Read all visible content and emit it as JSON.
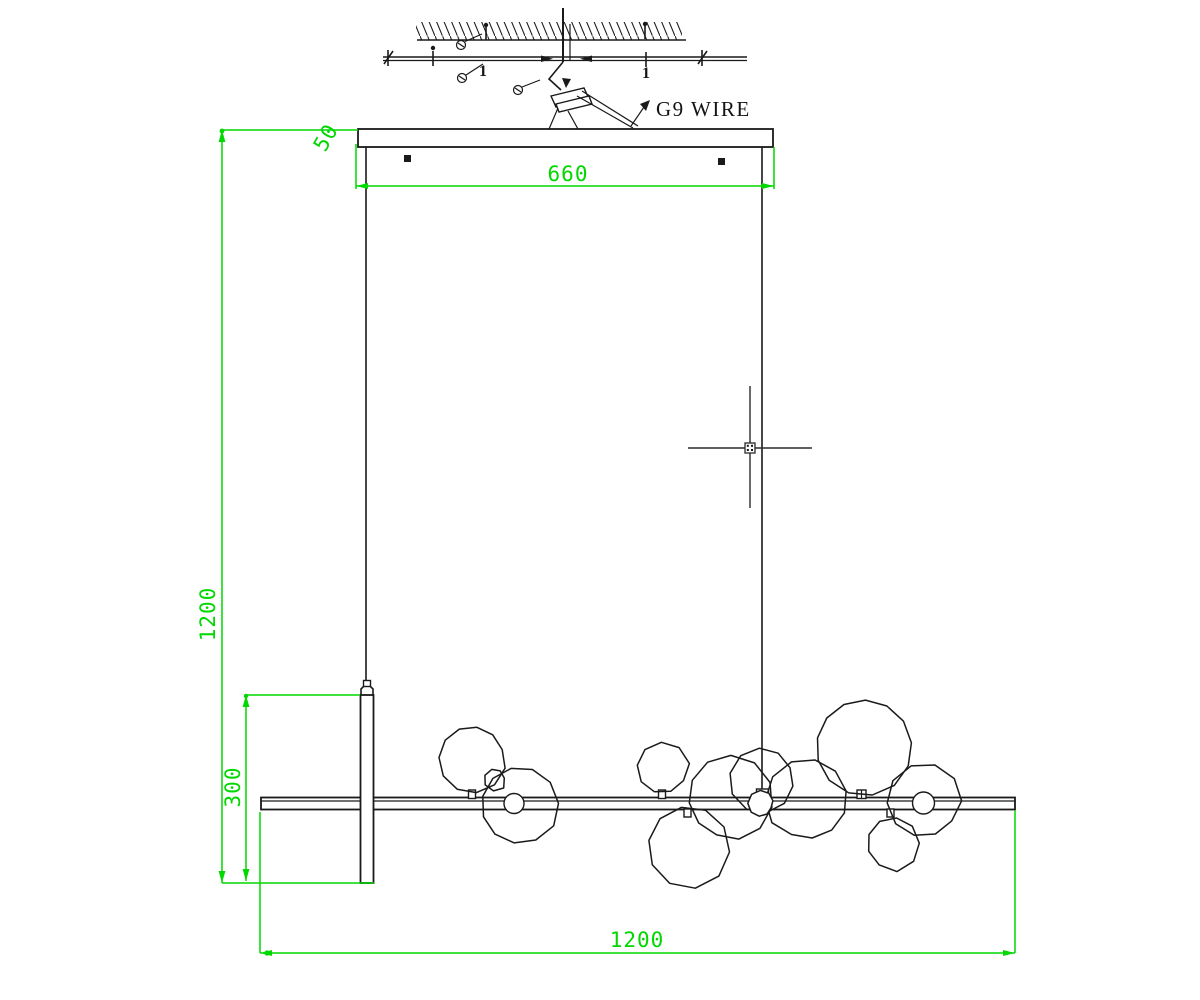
{
  "drawing": {
    "labels": {
      "wire": "G9 WIRE",
      "plate_mark": "1"
    },
    "dimensions": {
      "canopy_width": "660",
      "canopy_thickness": "50",
      "drop_height": "1200",
      "rod_height": "300",
      "fixture_length": "1200"
    },
    "colors": {
      "dimension_green": "#00d800",
      "line_black": "#1a1a1a",
      "background": "#ffffff"
    },
    "cursor": "crosshair-with-pickbox"
  }
}
